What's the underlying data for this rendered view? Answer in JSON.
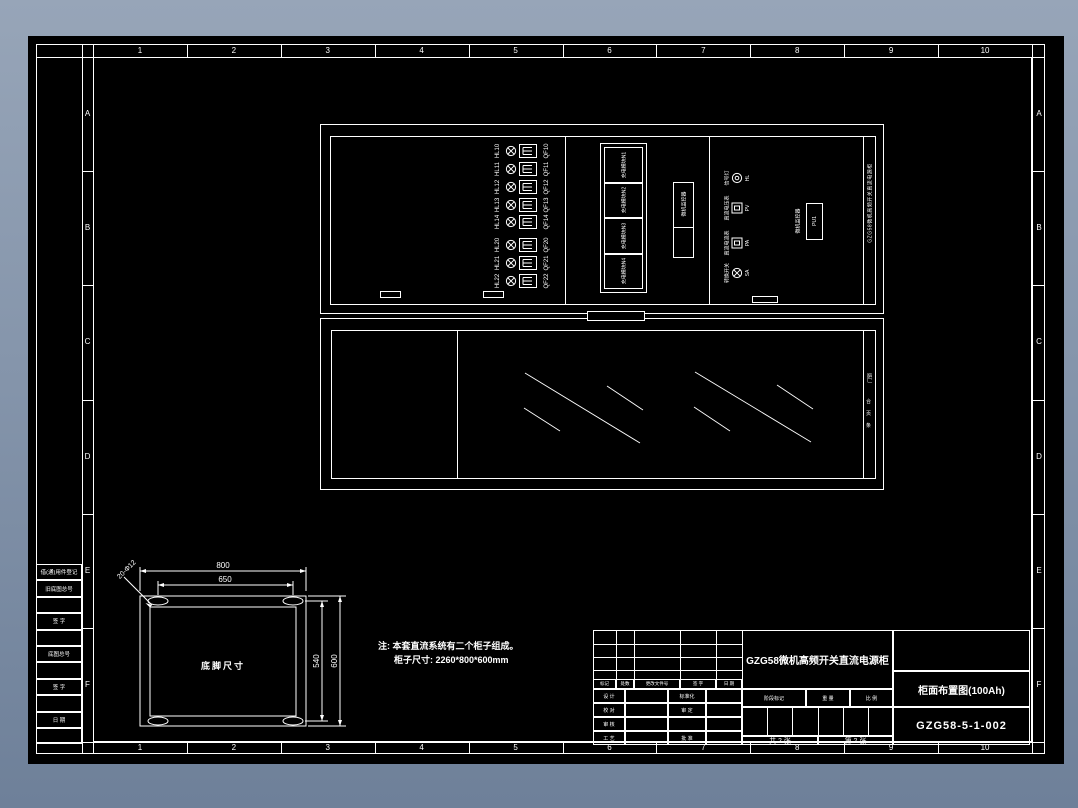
{
  "viewer": {
    "bg_top": "#97a5b8",
    "bg_bottom": "#6e8099",
    "sheet_color": "#000000",
    "line_color": "#ffffff"
  },
  "ruler": {
    "columns": [
      "1",
      "2",
      "3",
      "4",
      "5",
      "6",
      "7",
      "8",
      "9",
      "10"
    ],
    "rows": [
      "A",
      "B",
      "C",
      "D",
      "E",
      "F"
    ]
  },
  "margin_strip": {
    "rows": [
      "借(通)用件登记",
      "旧底图总号",
      "",
      "签  字",
      "",
      "底图总号",
      "",
      "签  字",
      "",
      "日  期",
      ""
    ]
  },
  "upper_view": {
    "breaker_rows": [
      {
        "lamp": "HL10",
        "breaker": "QF10"
      },
      {
        "lamp": "HL11",
        "breaker": "QF11"
      },
      {
        "lamp": "HL12",
        "breaker": "QF12"
      },
      {
        "lamp": "HL13",
        "breaker": "QF13"
      },
      {
        "lamp": "HL14",
        "breaker": "QF14"
      },
      {
        "lamp": "HL20",
        "breaker": "QF20"
      },
      {
        "lamp": "HL21",
        "breaker": "QF21"
      },
      {
        "lamp": "HL22",
        "breaker": "QF22"
      }
    ],
    "modules": [
      "充电模块N1",
      "充电模块N2",
      "充电模块N3",
      "充电模块N4"
    ],
    "module_monitor_label": "微机监控器",
    "instruments": [
      {
        "label": "信号灯",
        "tag": "HL",
        "symbol": "lamp2"
      },
      {
        "label": "直流电压表",
        "tag": "PV",
        "symbol": "meter"
      },
      {
        "label": "直流电流表",
        "tag": "PA",
        "symbol": "meter"
      },
      {
        "label": "转换开关",
        "tag": "SA",
        "symbol": "lamp"
      }
    ],
    "monitor_unit": {
      "label": "微机监控器",
      "tag": "PU1"
    },
    "side_label": "GZG58微机高频开关直流电源柜"
  },
  "lower_view": {
    "side_word": "门锁",
    "side_marks": [
      "合",
      "页",
      "条"
    ]
  },
  "foot_detail": {
    "title": "底脚尺寸",
    "dims": {
      "top_outer": "800",
      "top_inner": "650",
      "right_inner": "540",
      "right_outer": "600"
    },
    "leader": "20-Φ12"
  },
  "notes": {
    "line1": "注: 本套直流系统有二个柜子组成。",
    "line2": "柜子尺寸: 2260*800*600mm"
  },
  "title_block": {
    "product_title": "GZG58微机高频开关直流电源柜",
    "drawing_title": "柜面布置图(100Ah)",
    "drawing_number": "GZG58-5-1-002",
    "header_cells": [
      "标记",
      "处数",
      "更改文件号",
      "签 字",
      "日 期"
    ],
    "sign_rows": [
      {
        "role": "设 计",
        "mid": "标准化"
      },
      {
        "role": "校 对",
        "mid": "审 定"
      },
      {
        "role": "审 核",
        "mid": ""
      },
      {
        "role": "工 艺",
        "mid": "批 准"
      }
    ],
    "stage_cells": [
      "阶段标记",
      "重 量",
      "比 例"
    ],
    "sheet_count": "共 2 张",
    "sheet_index": "第 2 张"
  }
}
